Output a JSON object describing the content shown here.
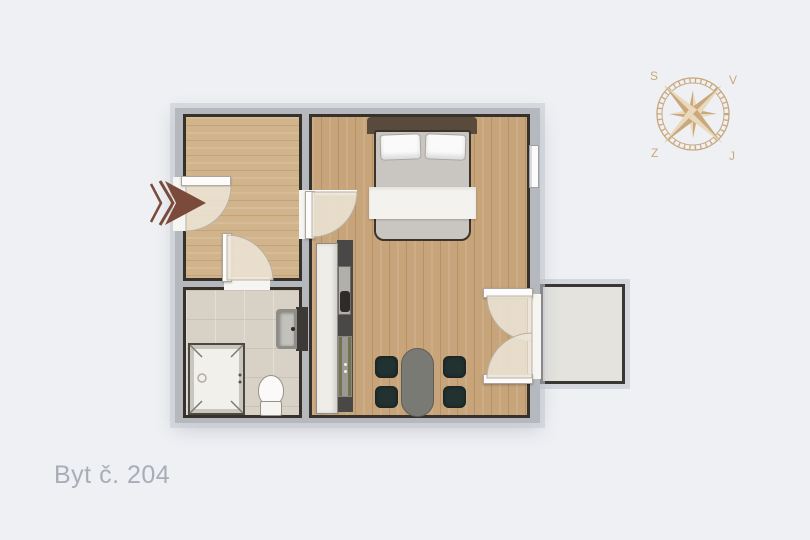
{
  "title": {
    "label": "Byt č. 204"
  },
  "compass": {
    "letters": [
      "S",
      "V",
      "Z",
      "J"
    ]
  },
  "colors": {
    "bg": "#eef0f4",
    "wall": "#b5b9bd",
    "line": "#36312b",
    "wood_hall": "#d2b48c",
    "wood_main": "#c7a47a",
    "tile": "#d8d2c6",
    "balcony_floor": "#e4e3de",
    "fixture_white": "#f6f5f1",
    "counter_white": "#efede7",
    "kitchen_dark": "#4a4846",
    "headboard": "#5a4a3c",
    "mattress": "#c9c6c1",
    "table": "#7a7a74",
    "chair": "#223231",
    "arrow": "#7a4b3a",
    "compass": "#c9a87c",
    "compass_light": "#ead9bd",
    "arc": "#ece4d5",
    "label": "#a9adb8"
  }
}
